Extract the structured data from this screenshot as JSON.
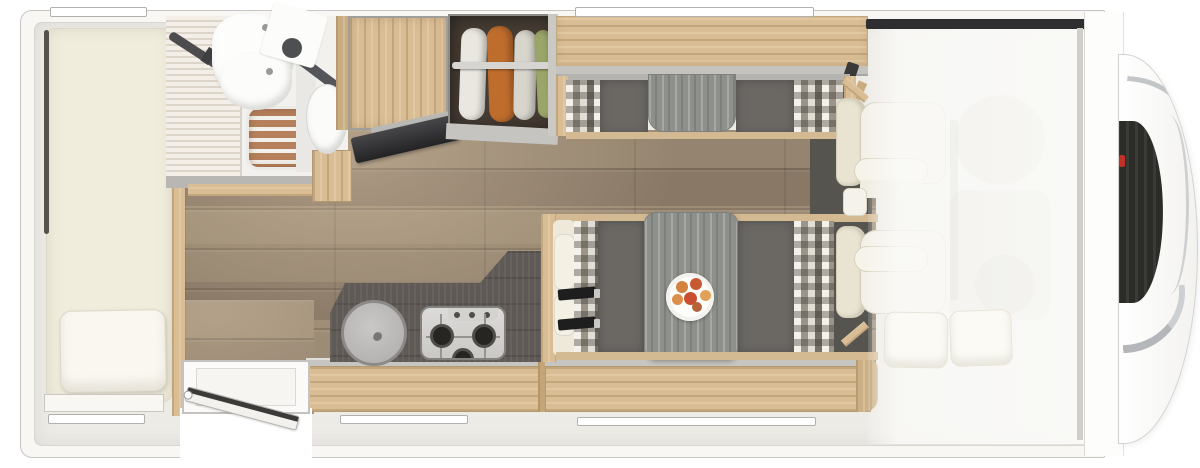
{
  "title": "Motorhome floor plan (top view)",
  "palette": {
    "body_white": "#f8f7f4",
    "interior_wall": "#edebe6",
    "floor_brown": "#93826e",
    "wood_light": "#d8bd95",
    "counter_dark": "#5f5a55",
    "bench_gray": "#6b6864",
    "table_gray": "#8e908c",
    "upholstery_cream": "#f1eddd",
    "checker_taupe": "#b7b1a6",
    "cab_mat_dark": "#56544e",
    "windshield_dark": "#2e2e30",
    "grille_dark": "#2b2b28",
    "chrome": "#c3c6c8",
    "logo_red": "#c23127",
    "garment_orange": "#bf6d2d",
    "garment_green": "#9aa569",
    "shower_wood": "#b5805c"
  },
  "areas": {
    "vehicle": {
      "label": "motorhome floor plan, rear at left, cab at right"
    },
    "rear_bed": {
      "label": "rear transverse bed with pillow"
    },
    "bathroom": {
      "label": "bathroom: corner washbasin, shower with wooden grate, toilet"
    },
    "shower": {
      "label": "shower tray with wooden slatted grate"
    },
    "washbasin": {
      "label": "corner washbasin"
    },
    "toilet": {
      "label": "toilet"
    },
    "wardrobe": {
      "label": "wardrobe cabinet"
    },
    "tv": {
      "label": "flat-screen TV on swivel mount"
    },
    "closet": {
      "label": "open closet with four hanging garments"
    },
    "kitchen": {
      "label": "kitchen block: round sink and 3-burner gas hob"
    },
    "sink": {
      "label": "round kitchen sink with lid"
    },
    "hob": {
      "label": "3-burner gas hob"
    },
    "entry_door": {
      "label": "entry door shown open"
    },
    "dinette": {
      "label": "face-to-face dinette benches with checkered cushions"
    },
    "dinette_table": {
      "label": "dinette table with plate of fruit"
    },
    "fruit_plate": {
      "label": "white plate with fruit"
    },
    "seat_belts": {
      "label": "seat belts on forward-facing bench"
    },
    "overhead_shelf": {
      "label": "overhead locker above dinette"
    },
    "cab_seats": {
      "label": "two cab seats"
    },
    "drop_down_bed": {
      "label": "stowed drop-down bed with two pillows (translucent)"
    },
    "windshield": {
      "label": "windscreen top edge"
    },
    "front_nose": {
      "label": "vehicle front with grille and red badge"
    },
    "windows": {
      "label": "window openings in walls",
      "count": 5
    }
  }
}
